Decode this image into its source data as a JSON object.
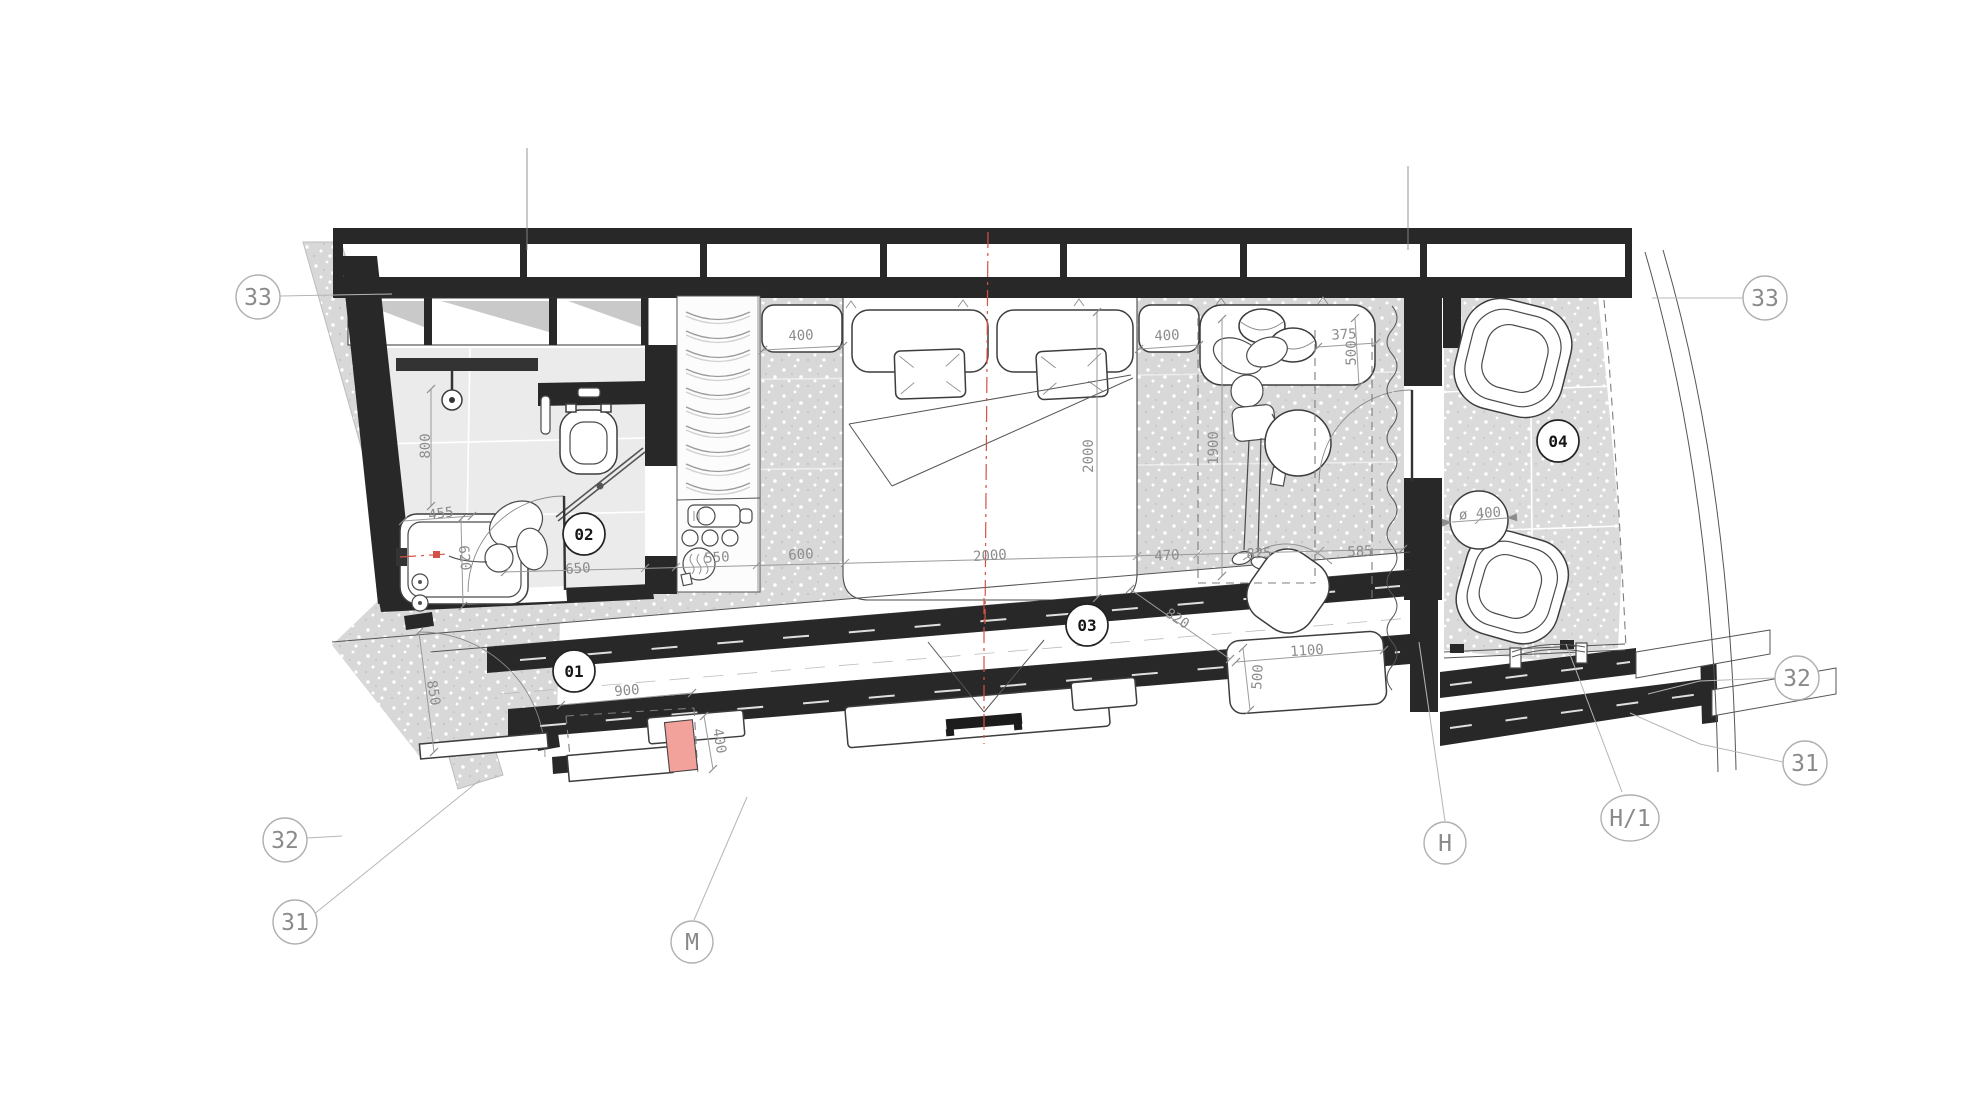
{
  "drawing": {
    "type": "architectural-floor-plan",
    "colors": {
      "wall": "#282828",
      "floor_gray": "#d8d8d8",
      "bath_floor": "#ebebeb",
      "dim_text": "#8c8c8c",
      "axis_red": "#d35247",
      "highlight_pink": "#f2a19b"
    },
    "room_tags": [
      {
        "t": "01",
        "x": 574,
        "y": 671
      },
      {
        "t": "02",
        "x": 584,
        "y": 534
      },
      {
        "t": "03",
        "x": 1087,
        "y": 625
      },
      {
        "t": "04",
        "x": 1558,
        "y": 441
      }
    ],
    "grid_bubbles": [
      {
        "t": "33",
        "x": 258,
        "y": 297,
        "rx": 22,
        "ry": 22
      },
      {
        "t": "33",
        "x": 1765,
        "y": 298,
        "rx": 22,
        "ry": 22
      },
      {
        "t": "32",
        "x": 1797,
        "y": 678,
        "rx": 22,
        "ry": 22
      },
      {
        "t": "31",
        "x": 1805,
        "y": 763,
        "rx": 22,
        "ry": 22
      },
      {
        "t": "32",
        "x": 285,
        "y": 840,
        "rx": 22,
        "ry": 22
      },
      {
        "t": "31",
        "x": 295,
        "y": 922,
        "rx": 22,
        "ry": 22
      },
      {
        "t": "M",
        "x": 692,
        "y": 942,
        "rx": 21,
        "ry": 21
      },
      {
        "t": "H",
        "x": 1445,
        "y": 843,
        "rx": 21,
        "ry": 21
      },
      {
        "t": "H/1",
        "x": 1630,
        "y": 818,
        "rx": 29,
        "ry": 23
      }
    ],
    "dimensions": [
      {
        "t": "400",
        "x": 801,
        "y": 336,
        "r": -3
      },
      {
        "t": "2000",
        "x": 1089,
        "y": 456,
        "r": -90
      },
      {
        "t": "400",
        "x": 1167,
        "y": 336,
        "r": -3
      },
      {
        "t": "375",
        "x": 1344,
        "y": 335,
        "r": -3
      },
      {
        "t": "500",
        "x": 1352,
        "y": 353,
        "r": -90
      },
      {
        "t": "1900",
        "x": 1214,
        "y": 448,
        "r": -90
      },
      {
        "t": "800",
        "x": 426,
        "y": 446,
        "r": -90
      },
      {
        "t": "455",
        "x": 441,
        "y": 514,
        "r": -8
      },
      {
        "t": "620",
        "x": 464,
        "y": 558,
        "r": 85
      },
      {
        "t": "850",
        "x": 433,
        "y": 693,
        "r": 80
      },
      {
        "t": "900",
        "x": 627,
        "y": 691,
        "r": -5
      },
      {
        "t": "400",
        "x": 719,
        "y": 741,
        "r": 80
      },
      {
        "t": "650",
        "x": 578,
        "y": 569,
        "r": -4
      },
      {
        "t": "550",
        "x": 717,
        "y": 558,
        "r": -4
      },
      {
        "t": "600",
        "x": 801,
        "y": 555,
        "r": -4
      },
      {
        "t": "2000",
        "x": 990,
        "y": 556,
        "r": -4
      },
      {
        "t": "470",
        "x": 1167,
        "y": 556,
        "r": -3
      },
      {
        "t": "825",
        "x": 1259,
        "y": 554,
        "r": -3
      },
      {
        "t": "585",
        "x": 1360,
        "y": 552,
        "r": -3
      },
      {
        "t": "820",
        "x": 1177,
        "y": 619,
        "r": 33
      },
      {
        "t": "1100",
        "x": 1307,
        "y": 651,
        "r": -4
      },
      {
        "t": "500",
        "x": 1258,
        "y": 677,
        "r": -86
      },
      {
        "t": "ø 400",
        "x": 1480,
        "y": 514,
        "r": -4
      }
    ]
  }
}
